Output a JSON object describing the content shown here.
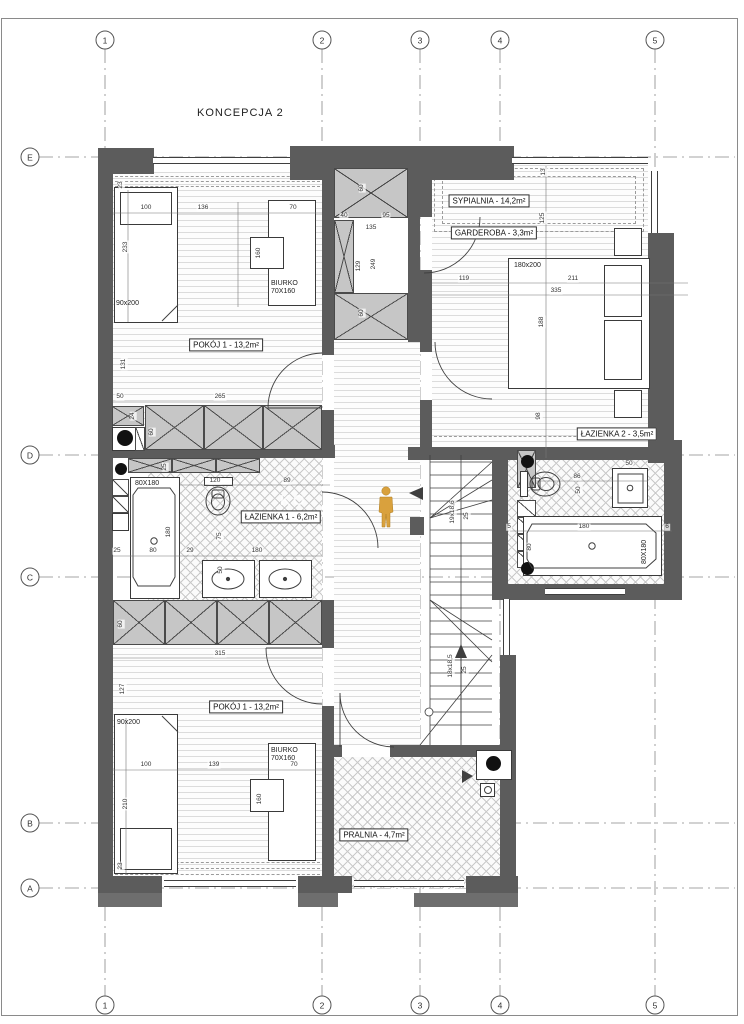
{
  "title": "KONCEPCJA 2",
  "watermark": {
    "text": "KO"
  },
  "colors": {
    "wall": "#5c5c5c",
    "cabinet_fill": "#c6c6c6",
    "line": "#3a3a3a",
    "grid_line": "#888888",
    "person": "#d9a13d",
    "background": "#ffffff"
  },
  "grid": {
    "columns": [
      {
        "label": "1",
        "x": 105
      },
      {
        "label": "2",
        "x": 322
      },
      {
        "label": "3",
        "x": 420
      },
      {
        "label": "4",
        "x": 500
      },
      {
        "label": "5",
        "x": 655
      }
    ],
    "rows": [
      {
        "label": "E",
        "y": 157
      },
      {
        "label": "D",
        "y": 455
      },
      {
        "label": "C",
        "y": 577
      },
      {
        "label": "B",
        "y": 823
      },
      {
        "label": "A",
        "y": 888
      }
    ],
    "top_bubble_y": 40,
    "bottom_bubble_y": 1005,
    "left_bubble_x": 30
  },
  "room_labels": [
    {
      "text": "POKÓJ 1 - 13,2m²",
      "x": 226,
      "y": 345
    },
    {
      "text": "SYPIALNIA - 14,2m²",
      "x": 489,
      "y": 201
    },
    {
      "text": "GARDEROBA - 3,3m²",
      "x": 494,
      "y": 233
    },
    {
      "text": "ŁAZIENKA 1 - 6,2m²",
      "x": 281,
      "y": 517
    },
    {
      "text": "ŁAZIENKA 2 - 3,5m²",
      "x": 617,
      "y": 434
    },
    {
      "text": "POKÓJ 1 - 13,2m²",
      "x": 246,
      "y": 707
    },
    {
      "text": "PRALNIA - 4,7m²",
      "x": 374,
      "y": 835
    }
  ],
  "furniture_labels": [
    {
      "t": "90x200",
      "x": 116,
      "y": 300
    },
    {
      "t": "BIURKO\n70X160",
      "x": 271,
      "y": 280
    },
    {
      "t": "180x200",
      "x": 514,
      "y": 262
    },
    {
      "t": "80X180",
      "x": 135,
      "y": 480
    },
    {
      "t": "80X180",
      "x": 641,
      "y": 564,
      "r": 1
    },
    {
      "t": "90x200",
      "x": 117,
      "y": 719
    },
    {
      "t": "BIURKO\n70X160",
      "x": 271,
      "y": 747
    }
  ],
  "dimensions": [
    {
      "t": "23",
      "x": 121,
      "y": 185,
      "r": 1
    },
    {
      "t": "100",
      "x": 146,
      "y": 208
    },
    {
      "t": "136",
      "x": 203,
      "y": 208
    },
    {
      "t": "70",
      "x": 293,
      "y": 208
    },
    {
      "t": "233",
      "x": 126,
      "y": 247,
      "r": 1
    },
    {
      "t": "160",
      "x": 259,
      "y": 253,
      "r": 1
    },
    {
      "t": "131",
      "x": 124,
      "y": 364,
      "r": 1
    },
    {
      "t": "50",
      "x": 120,
      "y": 397
    },
    {
      "t": "265",
      "x": 220,
      "y": 397
    },
    {
      "t": "24",
      "x": 133,
      "y": 416,
      "r": 1
    },
    {
      "t": "60",
      "x": 152,
      "y": 432,
      "r": 1
    },
    {
      "t": "60",
      "x": 362,
      "y": 188,
      "r": 1
    },
    {
      "t": "40",
      "x": 344,
      "y": 216
    },
    {
      "t": "95",
      "x": 386,
      "y": 216
    },
    {
      "t": "135",
      "x": 371,
      "y": 228
    },
    {
      "t": "129",
      "x": 359,
      "y": 266,
      "r": 1
    },
    {
      "t": "249",
      "x": 374,
      "y": 264,
      "r": 1
    },
    {
      "t": "60",
      "x": 362,
      "y": 313,
      "r": 1
    },
    {
      "t": "13",
      "x": 544,
      "y": 172,
      "r": 1
    },
    {
      "t": "125",
      "x": 543,
      "y": 218,
      "r": 1
    },
    {
      "t": "119",
      "x": 464,
      "y": 279
    },
    {
      "t": "211",
      "x": 573,
      "y": 279
    },
    {
      "t": "335",
      "x": 556,
      "y": 291
    },
    {
      "t": "188",
      "x": 542,
      "y": 322,
      "r": 1
    },
    {
      "t": "98",
      "x": 539,
      "y": 416,
      "r": 1
    },
    {
      "t": "25",
      "x": 165,
      "y": 467,
      "r": 1
    },
    {
      "t": "120",
      "x": 215,
      "y": 481
    },
    {
      "t": "89",
      "x": 287,
      "y": 481
    },
    {
      "t": "75",
      "x": 220,
      "y": 536,
      "r": 1
    },
    {
      "t": "180",
      "x": 169,
      "y": 532,
      "r": 1
    },
    {
      "t": "25",
      "x": 117,
      "y": 551
    },
    {
      "t": "80",
      "x": 153,
      "y": 551
    },
    {
      "t": "29",
      "x": 190,
      "y": 551
    },
    {
      "t": "180",
      "x": 257,
      "y": 551
    },
    {
      "t": "50",
      "x": 221,
      "y": 570,
      "r": 1
    },
    {
      "t": "86",
      "x": 577,
      "y": 477
    },
    {
      "t": "50",
      "x": 629,
      "y": 464
    },
    {
      "t": "50",
      "x": 579,
      "y": 490,
      "r": 1
    },
    {
      "t": "5",
      "x": 509,
      "y": 527
    },
    {
      "t": "180",
      "x": 584,
      "y": 527
    },
    {
      "t": "6",
      "x": 667,
      "y": 527
    },
    {
      "t": "80",
      "x": 530,
      "y": 547,
      "r": 1
    },
    {
      "t": "19x18,6",
      "x": 453,
      "y": 512,
      "r": 1
    },
    {
      "t": "25",
      "x": 467,
      "y": 516,
      "r": 1
    },
    {
      "t": "18x18,5",
      "x": 451,
      "y": 666,
      "r": 1
    },
    {
      "t": "25",
      "x": 465,
      "y": 670,
      "r": 1
    },
    {
      "t": "315",
      "x": 220,
      "y": 654
    },
    {
      "t": "60",
      "x": 121,
      "y": 624,
      "r": 1
    },
    {
      "t": "127",
      "x": 123,
      "y": 689,
      "r": 1
    },
    {
      "t": "100",
      "x": 146,
      "y": 765
    },
    {
      "t": "139",
      "x": 214,
      "y": 765
    },
    {
      "t": "70",
      "x": 294,
      "y": 765
    },
    {
      "t": "210",
      "x": 126,
      "y": 804,
      "r": 1
    },
    {
      "t": "160",
      "x": 260,
      "y": 799,
      "r": 1
    },
    {
      "t": "23",
      "x": 121,
      "y": 866,
      "r": 1
    }
  ]
}
